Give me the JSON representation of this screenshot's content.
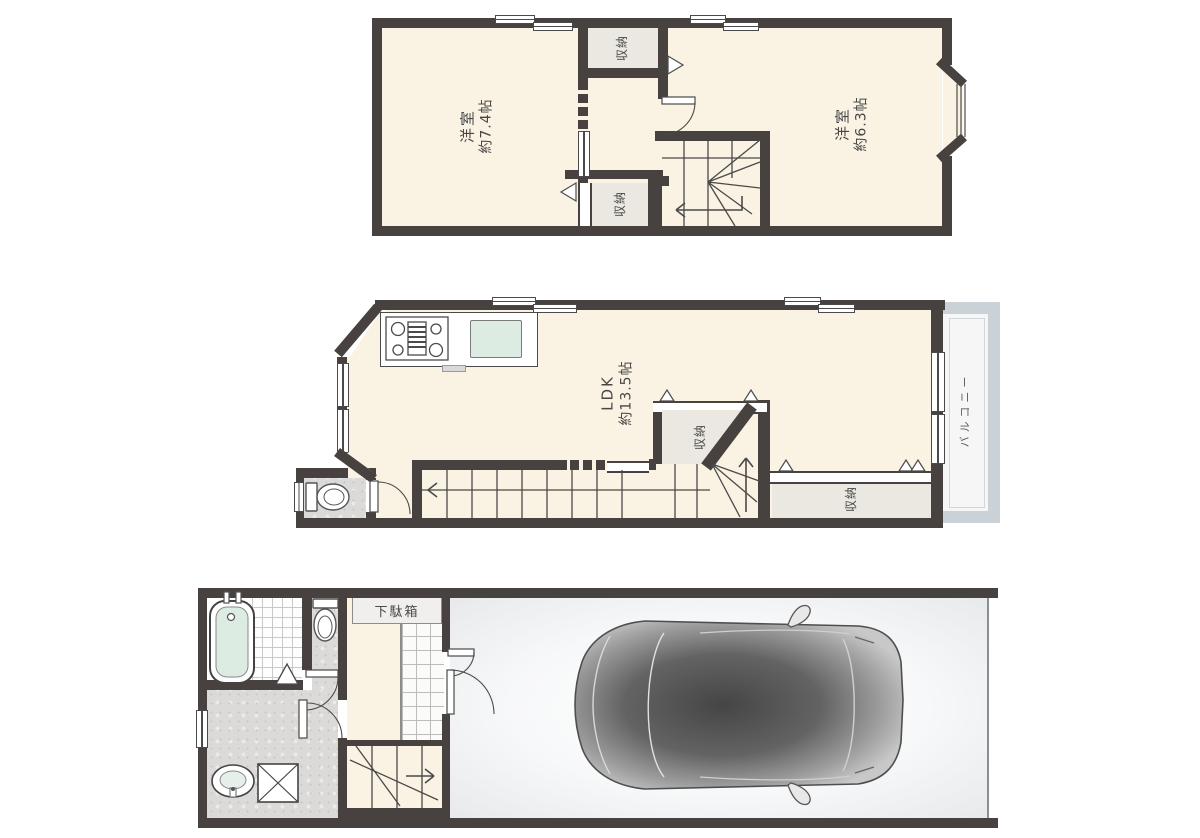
{
  "plan_title": "3-story house floor plan",
  "floor3": {
    "room_left_name": "洋室",
    "room_left_size": "約7.4帖",
    "room_right_name": "洋室",
    "room_right_size": "約6.3帖",
    "closet_top": "収納",
    "closet_bottom": "収納"
  },
  "floor2": {
    "ldk_name": "LDK",
    "ldk_size": "約13.5帖",
    "closet_center": "収納",
    "closet_right": "収納",
    "balcony": "バルコニー"
  },
  "floor1": {
    "shoe_cabinet": "下駄箱"
  },
  "colors": {
    "wall": "#474140",
    "floor_cream": "#faf3e3",
    "closet_gray": "#eae8e0",
    "balcony_frame": "#cbd2d7",
    "granite": "#dbdad8",
    "water_aqua": "#dcece3",
    "car_body": "#4a4a4a"
  }
}
